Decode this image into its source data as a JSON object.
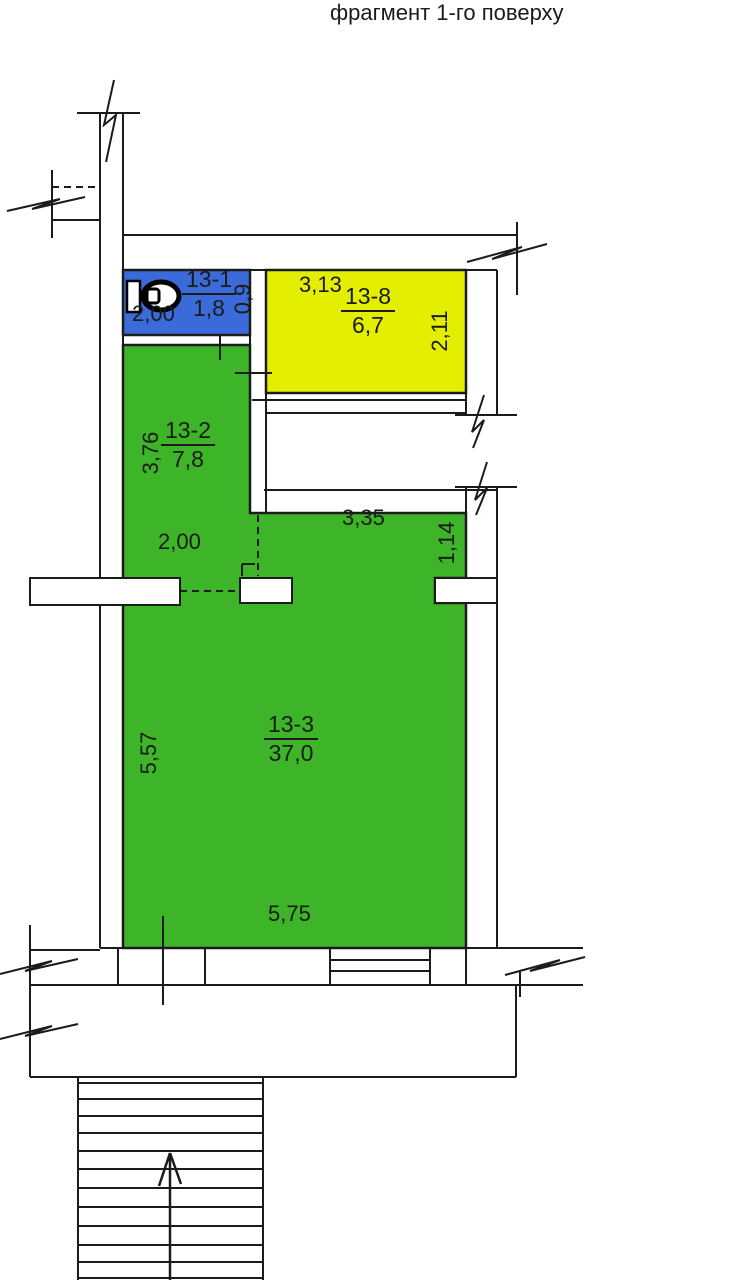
{
  "title": "фрагмент 1-го  поверху",
  "colors": {
    "wc_blue": "#3a6bd8",
    "room_yellow": "#e3ee00",
    "room_green": "#3eb429",
    "line": "#1b1b1b"
  },
  "rooms": [
    {
      "number": "13-1",
      "area": "1,8",
      "type": "wc",
      "dim_width": "2,00",
      "dim_depth": "0,9"
    },
    {
      "number": "13-8",
      "area": "6,7",
      "dim_width": "3,13",
      "dim_depth": "2,11"
    },
    {
      "number": "13-2",
      "area": "7,8",
      "dim_height": "3,76",
      "dim_opening": "2,00"
    },
    {
      "number": "13-3",
      "area": "37,0",
      "dim_height": "5,57",
      "dim_width": "5,75",
      "dim_corridor_width": "3,35",
      "dim_corridor_depth": "1,14"
    }
  ],
  "icons": {
    "toilet": "wc-toilet-plan-symbol",
    "stairs_arrow": "stairs-up-arrow"
  }
}
